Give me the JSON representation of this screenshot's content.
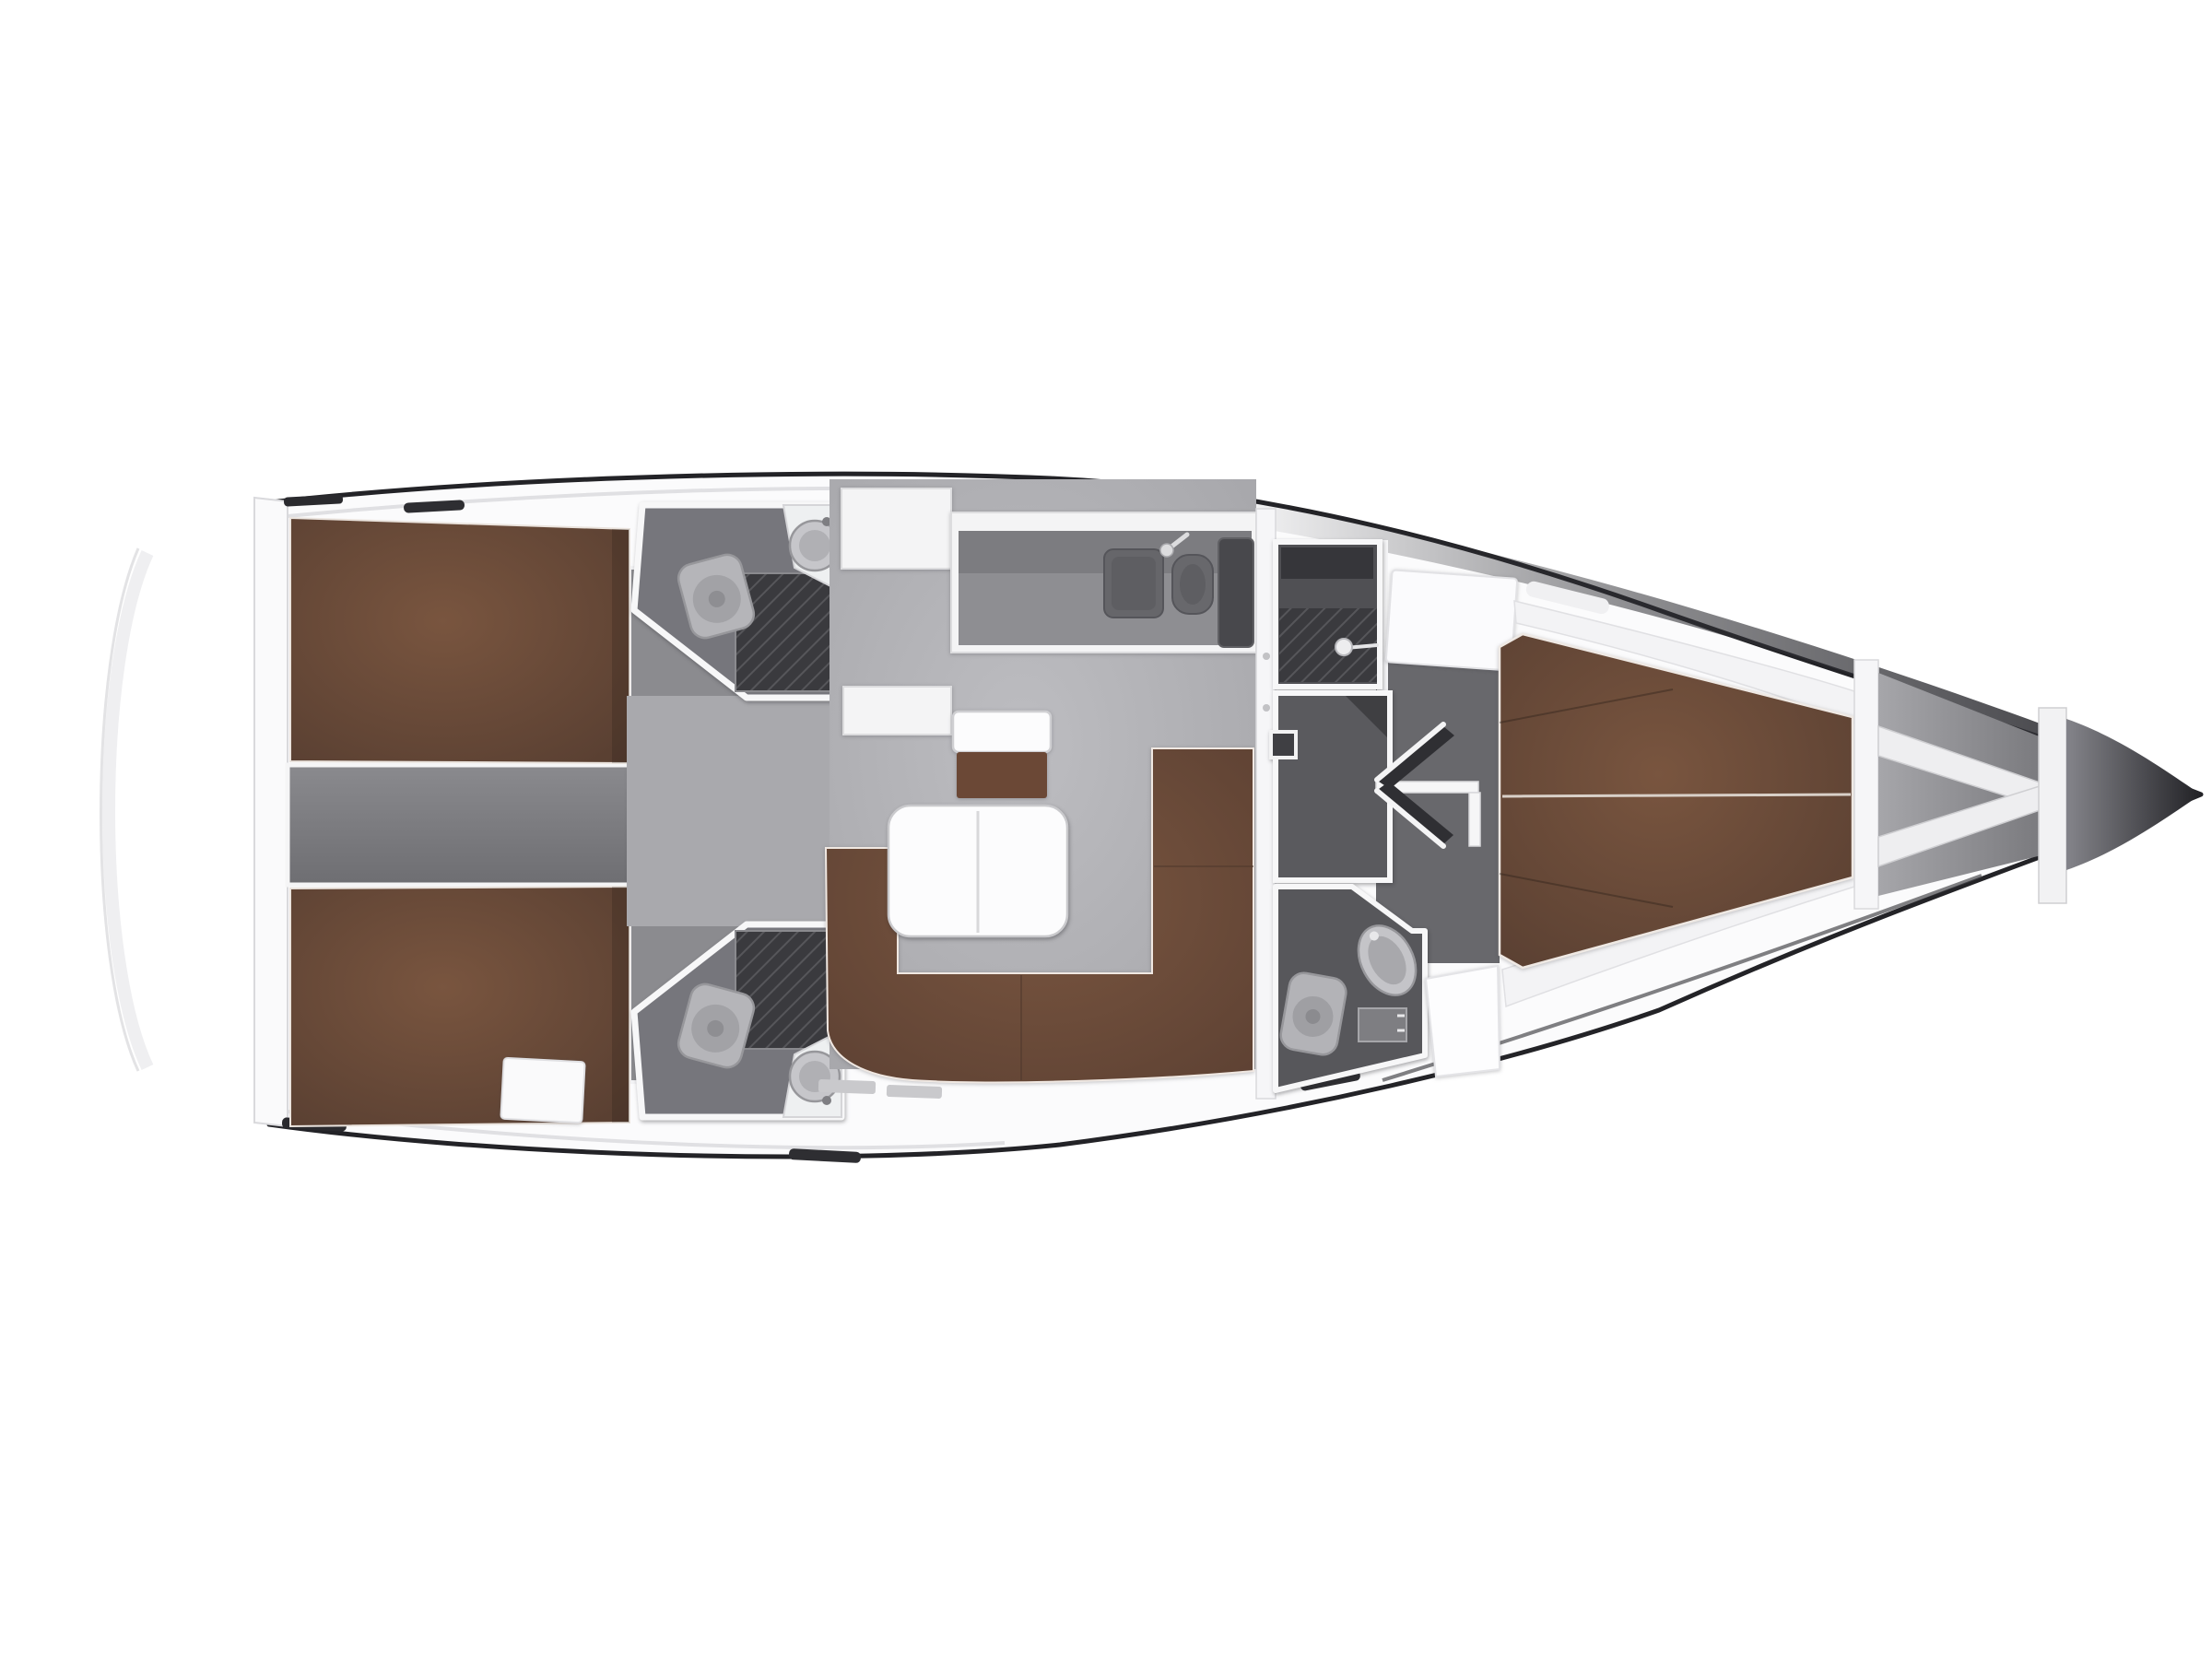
{
  "figure": {
    "kind": "sailing-yacht-interior-floor-plan",
    "view": "top-down",
    "orientation": "bow-right"
  },
  "colors": {
    "background": "#ffffff",
    "hullOutline": "#232327",
    "deckWhite": "#fbfbfc",
    "wallWhite": "#f6f6f8",
    "salonFloorLight": "#bdbdc1",
    "salonFloorDark": "#a3a3a7",
    "walkwayFloor": "#a9a9ad",
    "cabinFloor": "#8b8b8f",
    "fwdCabinFloor": "#68686c",
    "engineFloorLight": "#8a8a8e",
    "engineFloorDark": "#6e6e72",
    "showerRoom": "#505054",
    "dressingRoom": "#5a5a5e",
    "headFloor": "#76767c",
    "fwdHeadFloor": "#57575b",
    "hatchBase": "#3a3a3e",
    "hatchLine": "#56565a",
    "berthLight": "#79553f",
    "berthDark": "#573e31",
    "sofaLight": "#7a5640",
    "sofaDark": "#5d4133",
    "seatBrown": "#6b4836",
    "tableWhite": "#fcfcfd",
    "fixtureLight": "#c9c9cd",
    "worktopDark": "#7c7c80",
    "worktopMid": "#8e8e92",
    "stoveDark": "#48484c",
    "sinkDark": "#66666a",
    "stepTreadLight": "#fafafb",
    "stepTreadDark": "#c2c2c6",
    "bandDark": "#2e2e33",
    "tipLight": "#84848a",
    "tipDark": "#222226",
    "shelfWhite": "#f3f3f5"
  },
  "layout_facts": {
    "cabins": 3,
    "heads": 3,
    "shower_rooms": 1,
    "aft_double_berths": 2,
    "forward_v_berth": 1,
    "companionway_steps": 4,
    "galley_sinks": 2,
    "salon_table_leaves": 2,
    "toilets": 3,
    "wash_basins": 3
  }
}
